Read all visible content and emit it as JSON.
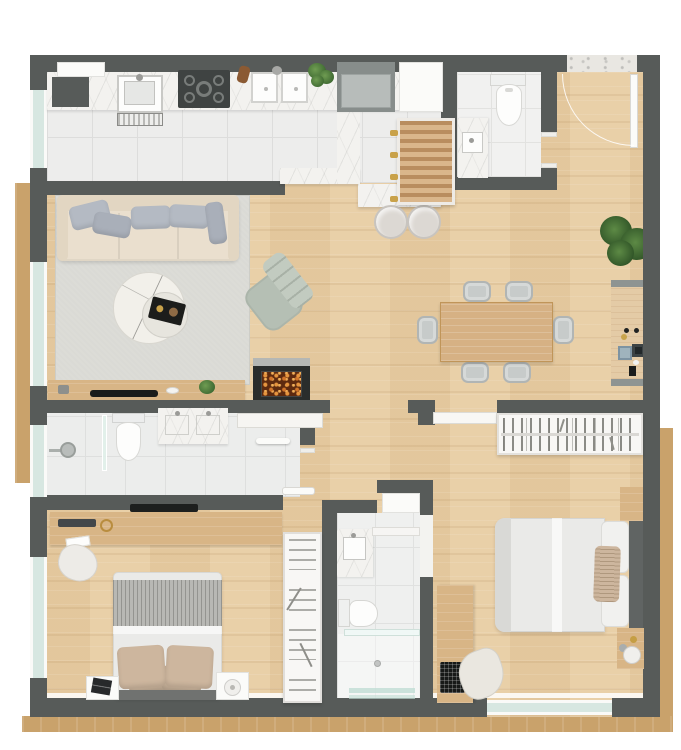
{
  "meta": {
    "kind": "architectural floor plan rendering, top-down 3D view",
    "visible_text_labels": []
  },
  "palette": {
    "wall": "#575b59",
    "wood": "#e8cda3",
    "woodfurn": "#d8b586",
    "tile": "#ededec",
    "tileline": "#dddddc",
    "bathtile": "#ecedec",
    "marble": "#f3f2ef",
    "rug": "#dadad5",
    "trim": "#c9a26b",
    "glass": "#d7e7e1",
    "sofa": "#eadfce",
    "cushion": "#b4bac3",
    "sage": "#b5bfb4",
    "graychair": "#c7cbca",
    "bedwhite": "#eaeae8",
    "throw": "#b8b8b4",
    "tanpillow": "#cdb69e",
    "headboard": "#707270",
    "rackwhite": "#f8f7f5",
    "ember": "#d0742a",
    "plantgreen": "#4a7a3c",
    "charcoal": "#1c1d1b",
    "background": "#ffffff"
  },
  "plan": {
    "rooms": [
      {
        "name": "kitchen",
        "floor": "white tile",
        "items": [
          "wall-shelf",
          "utility-sink",
          "washboard",
          "marble-counter",
          "cooktop-5-burners",
          "wood-utensil",
          "double-sink",
          "fresh-herbs",
          "refrigerator",
          "tall-cabinet",
          "slatted-rack",
          "island-counter",
          "peninsula-counter",
          "two-stools"
        ]
      },
      {
        "name": "powder-room",
        "floor": "tile",
        "items": [
          "toilet",
          "marble-vanity-sink"
        ]
      },
      {
        "name": "entry",
        "floor": "wood",
        "items": [
          "marble-threshold",
          "entry-door",
          "door-swing-arc"
        ]
      },
      {
        "name": "living-room",
        "floor": "wood with rug",
        "items": [
          "three-seat-sofa",
          "five-throw-pillows",
          "sage-armchair",
          "nesting-marble-coffee-tables",
          "black-decor-tray",
          "tv-console",
          "tv",
          "small-plant",
          "fireplace-with-embers"
        ]
      },
      {
        "name": "dining-room",
        "floor": "wood",
        "items": [
          "rectangular-table",
          "six-gray-chairs",
          "sideboard-bar",
          "decor-objects",
          "potted-plant"
        ]
      },
      {
        "name": "hallway",
        "floor": "wood",
        "items": [
          "sliding-door",
          "pocket-door",
          "white-bookshelf"
        ]
      },
      {
        "name": "bathroom-main",
        "floor": "tile",
        "items": [
          "walk-in-shower",
          "glass-partition",
          "shower-head",
          "toilet",
          "double-vanity",
          "towel-shelf"
        ]
      },
      {
        "name": "bedroom-1",
        "floor": "wood",
        "items": [
          "desk-dresser",
          "wall-tv",
          "keyboard",
          "glasses",
          "paper",
          "desk-chair",
          "double-bed",
          "knit-throw",
          "four-pillows",
          "headboard",
          "two-nightstands",
          "book",
          "lamp",
          "open-wardrobe-rack"
        ]
      },
      {
        "name": "bathroom-ensuite",
        "floor": "tile",
        "items": [
          "laundry-cabinet",
          "marble-vanity",
          "mirror-shelf",
          "toilet",
          "shower-with-glass",
          "drain",
          "glass-shelves"
        ]
      },
      {
        "name": "bedroom-2",
        "floor": "wood",
        "items": [
          "bookshelf",
          "double-bed",
          "duvet",
          "two-pillows",
          "woven-pillow",
          "headboard",
          "two-nightstands",
          "lamp",
          "clock",
          "desk",
          "laptop",
          "lounge-chair",
          "window"
        ]
      }
    ],
    "windows": [
      "kitchen-left",
      "living-left",
      "bathroom-left",
      "bedroom1-left",
      "bedroom2-bottom"
    ],
    "exterior": [
      "wood-trim-left",
      "wood-trim-right",
      "wood-trim-bottom",
      "entry-marble-threshold"
    ]
  }
}
